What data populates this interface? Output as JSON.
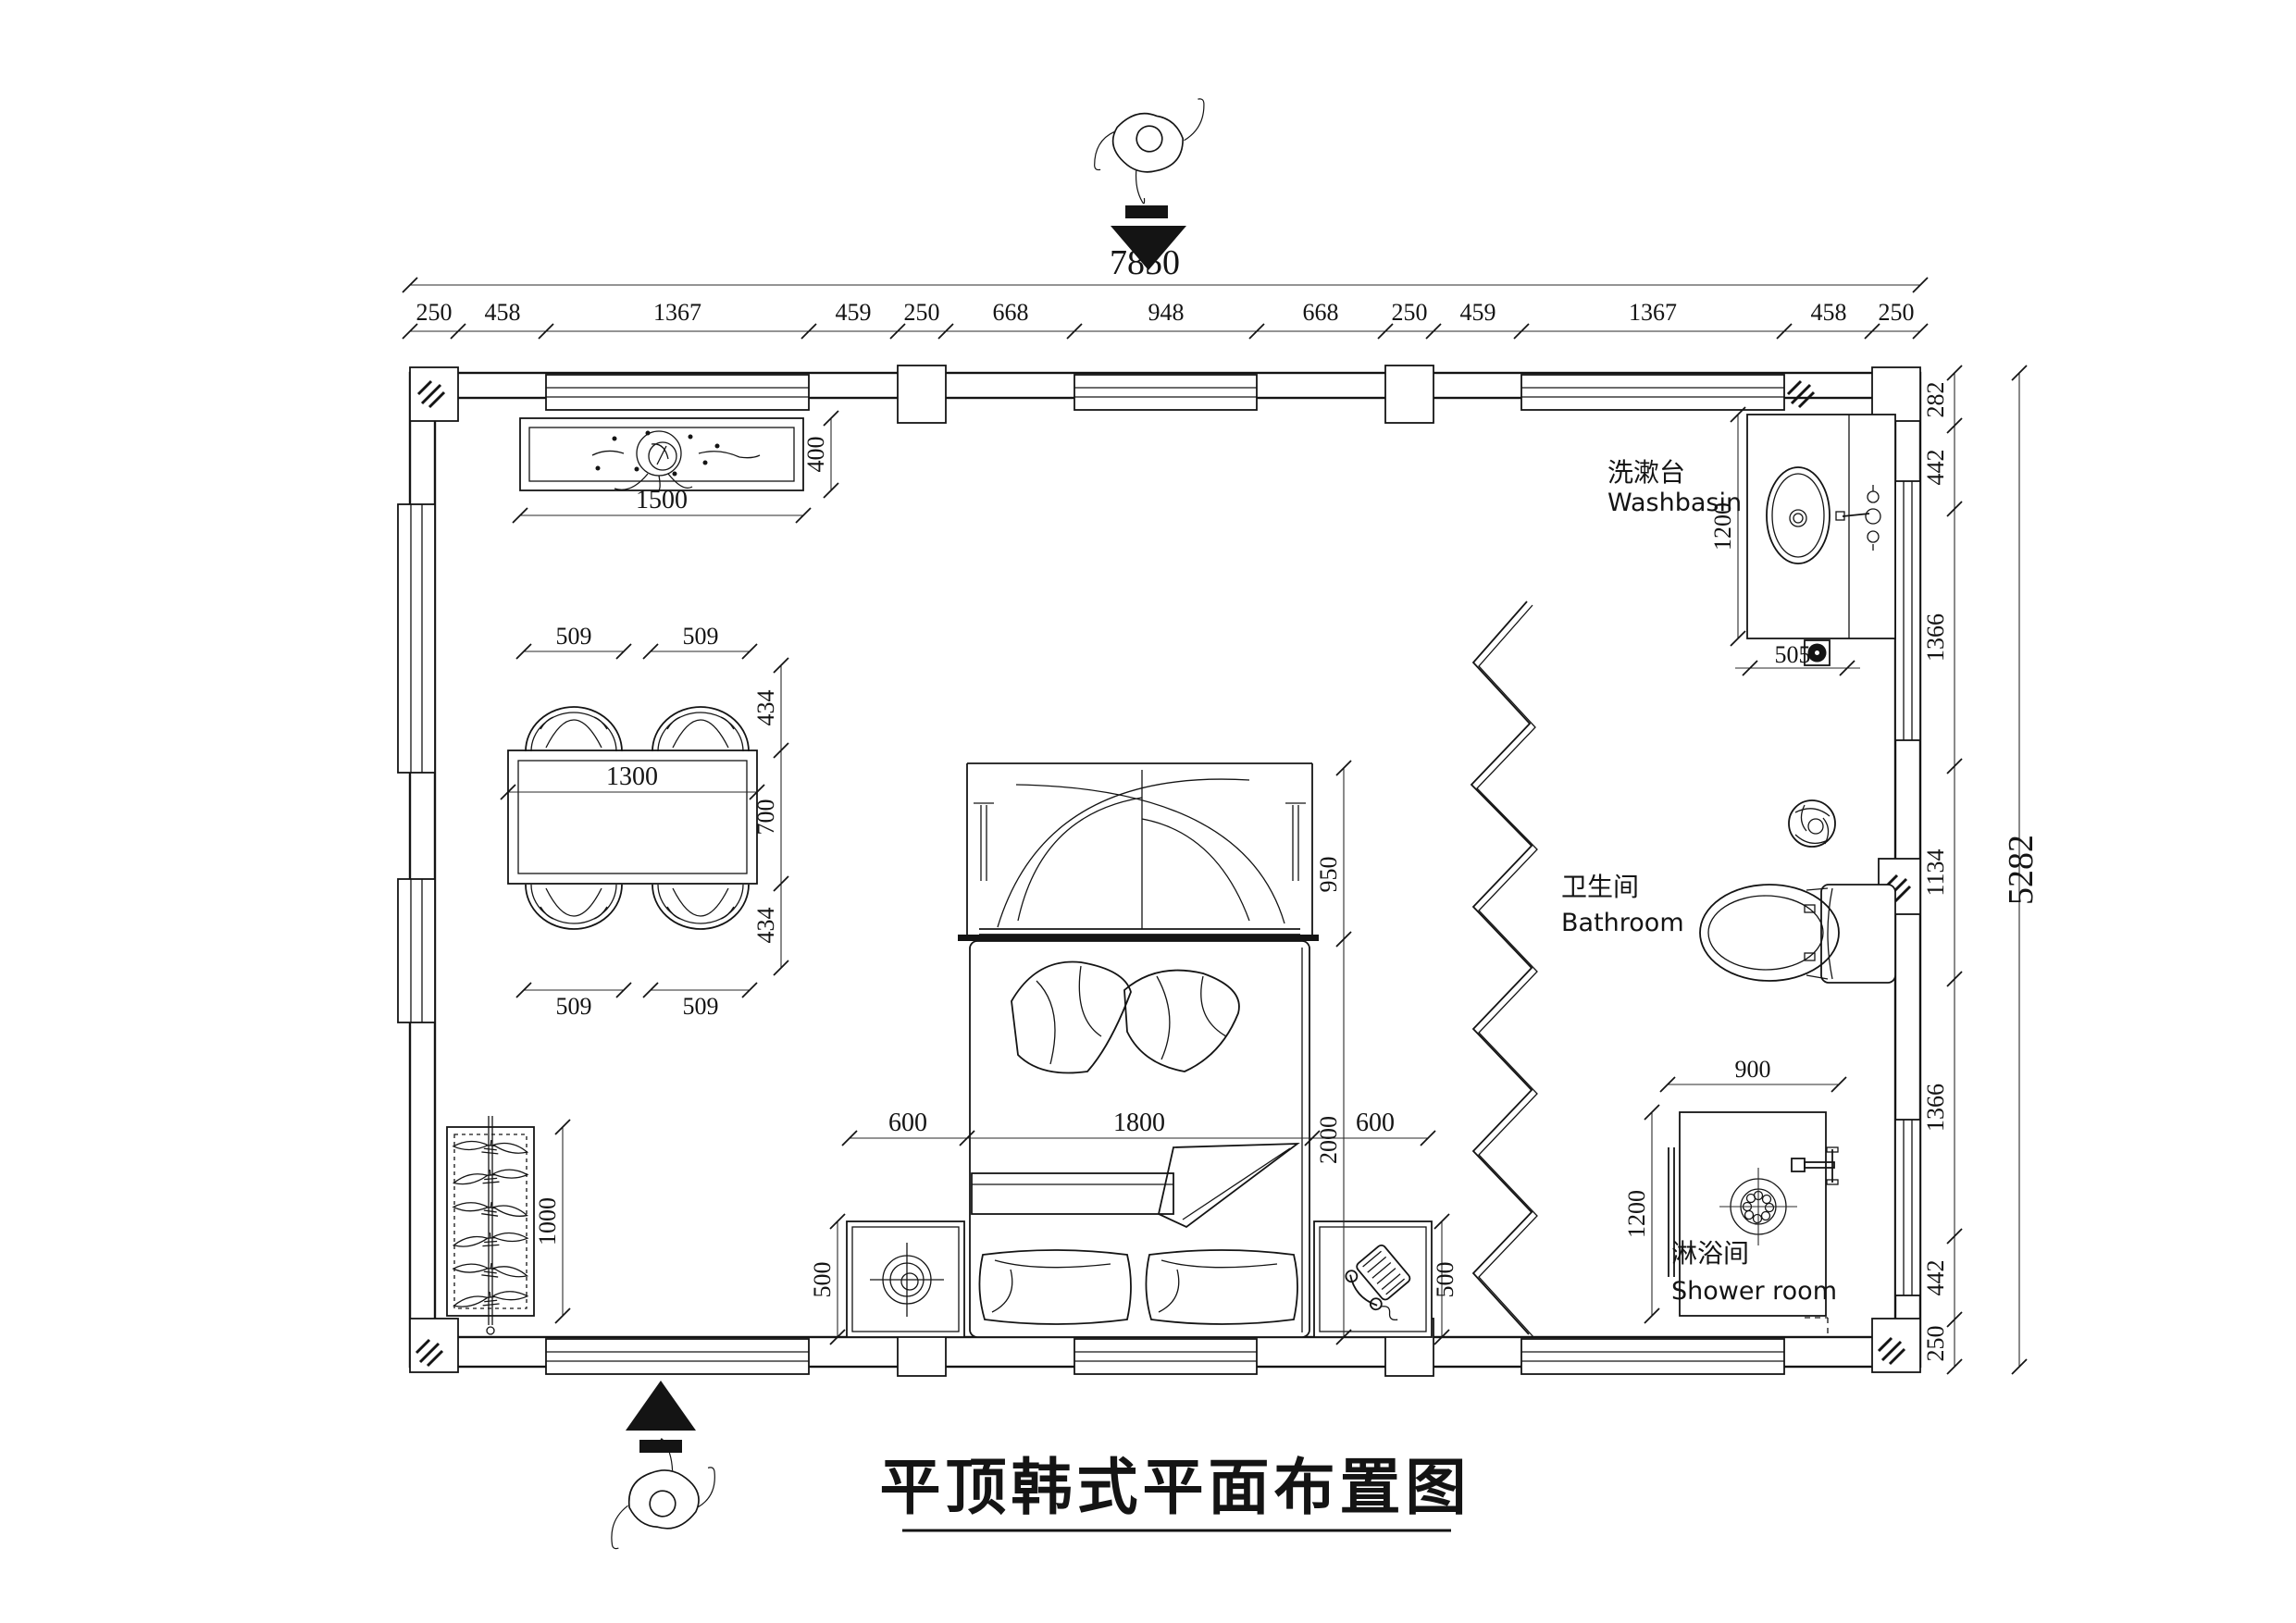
{
  "title": {
    "text": "平顶韩式平面布置图"
  },
  "dimensions": {
    "top_total": "7850",
    "top_chain": [
      "250",
      "458",
      "1367",
      "459",
      "250",
      "668",
      "948",
      "668",
      "250",
      "459",
      "1367",
      "458",
      "250"
    ],
    "right_total": "5282",
    "right_chain": [
      "282",
      "442",
      "1366",
      "1134",
      "1366",
      "442",
      "250"
    ],
    "cabinet_width": "1500",
    "cabinet_depth": "400",
    "table_width": "1300",
    "chair_top": [
      "509",
      "509"
    ],
    "chair_bottom": [
      "509",
      "509"
    ],
    "table_side": [
      "434",
      "700",
      "434"
    ],
    "canopy_depth": "950",
    "bed_length": "2000",
    "bed_row": [
      "600",
      "1800",
      "600"
    ],
    "nightstand_left": "500",
    "nightstand_right": "500",
    "wardrobe_height": "1000",
    "washbasin_depth": "1200",
    "washbasin_width": "505",
    "shower_width": "900",
    "shower_depth": "1200"
  },
  "labels": {
    "washbasin_zh": "洗漱台",
    "washbasin_en": "Washbasin",
    "bathroom_zh": "卫生间",
    "bathroom_en": "Bathroom",
    "shower_zh": "淋浴间",
    "shower_en": "Shower room"
  }
}
